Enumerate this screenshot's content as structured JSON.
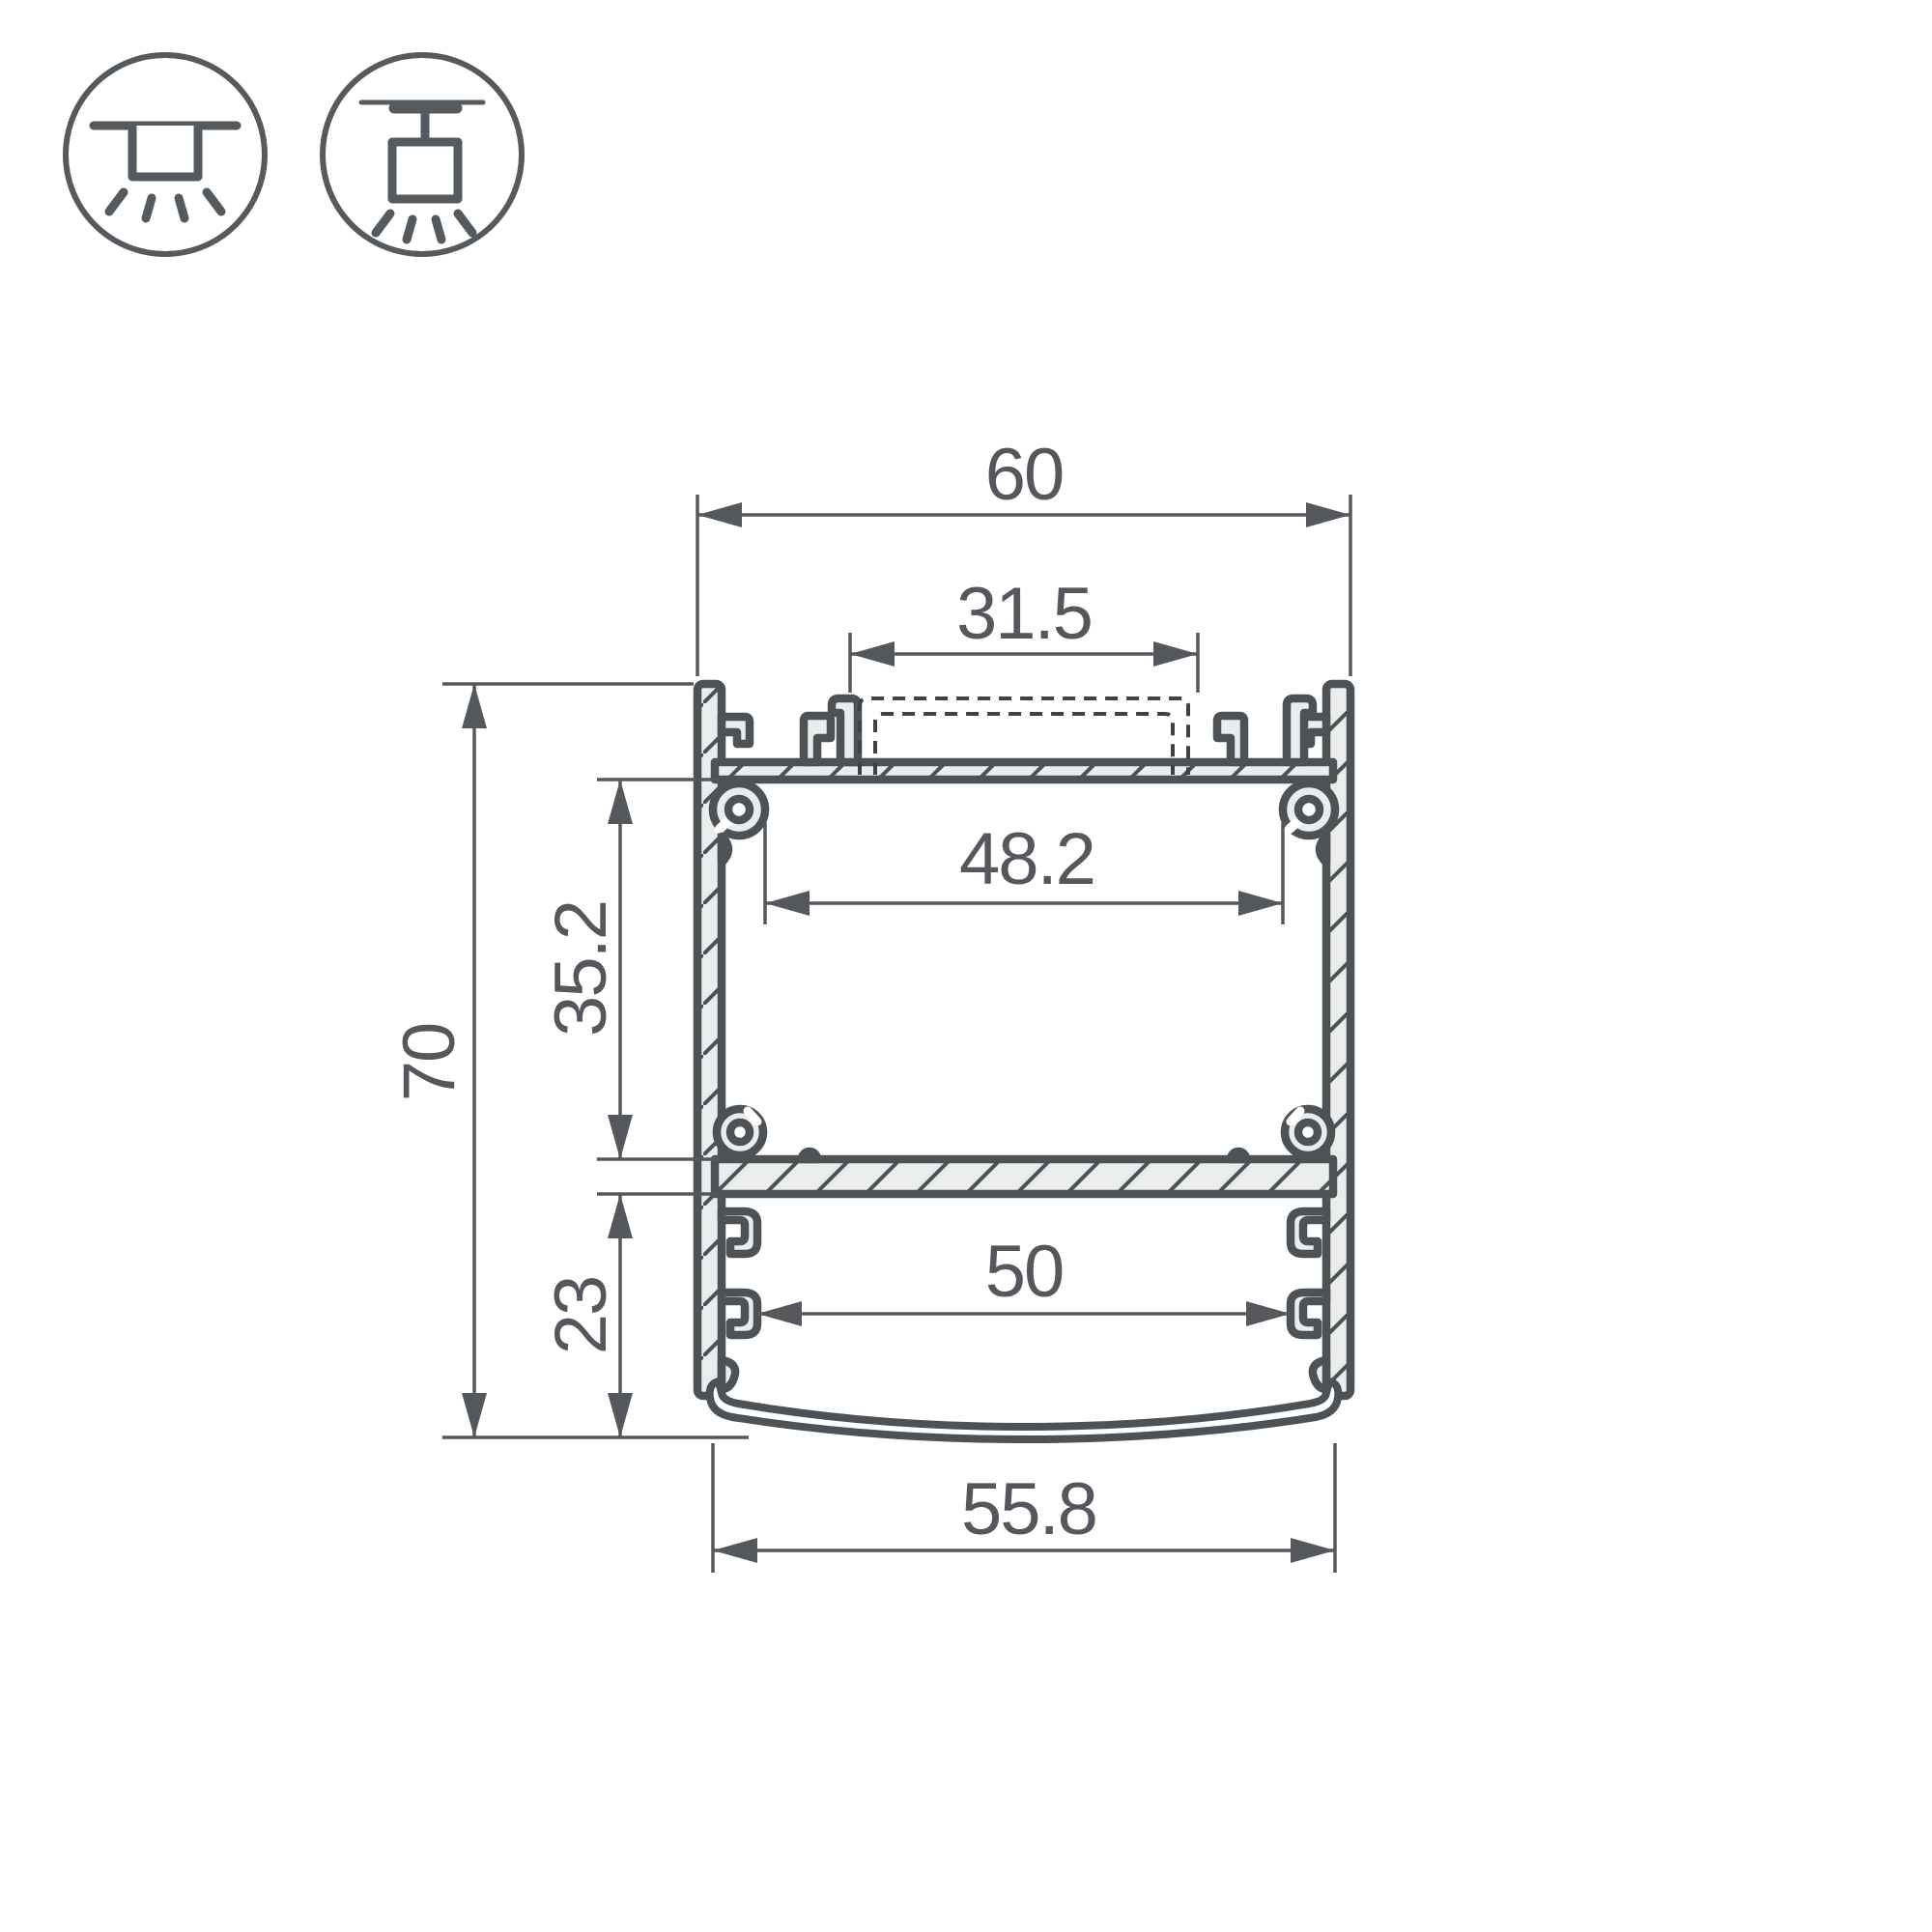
{
  "drawing": {
    "title": "LED aluminium profile cross-section technical drawing",
    "mount_icons": [
      {
        "name": "surface-ceiling-mount-icon"
      },
      {
        "name": "suspended-pendant-mount-icon"
      }
    ],
    "dimensions": {
      "overall_width": "60",
      "top_slot_width": "31.5",
      "upper_inner_width": "48.2",
      "upper_chamber_height": "35.2",
      "overall_height": "70",
      "lower_chamber_height": "23",
      "lower_inner_width": "50",
      "diffuser_width": "55.8"
    },
    "colors": {
      "outline": "#4d5257",
      "metal_fill": "#ebecec",
      "dim_line": "#54585c",
      "text": "#54585c",
      "background": "#ffffff"
    }
  }
}
